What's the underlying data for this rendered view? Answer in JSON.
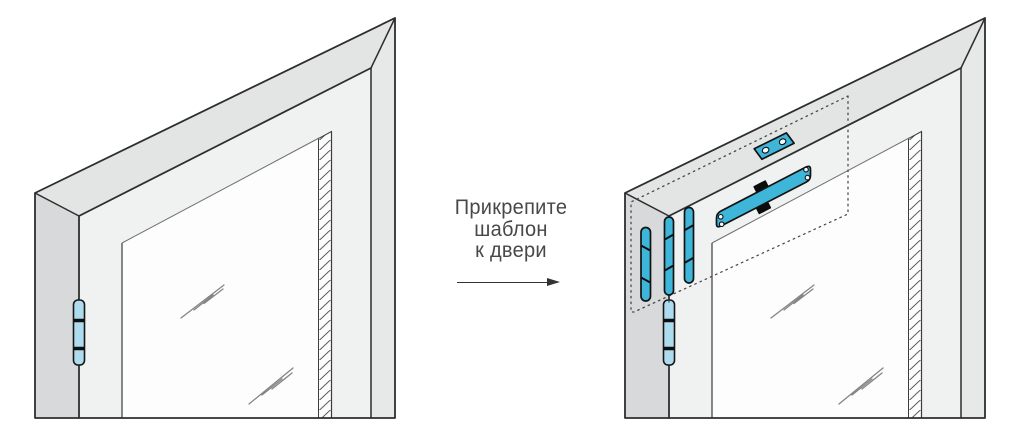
{
  "caption": {
    "line1": "Прикрепите",
    "line2": "шаблон",
    "line3": "к двери"
  },
  "arrow": {
    "direction": "right"
  },
  "colors": {
    "face_side": "#d8d9da",
    "face_top": "#e3e4e4",
    "face_front": "#f0f1f1",
    "face_right": "#e7e8e8",
    "glass": "#fdfdfd",
    "line": "#2e2e2e",
    "template_blue": "#3db6d9",
    "hinge_blue": "#addcee",
    "dotted": "#4a4a4a",
    "text": "#484848",
    "arrow": "#333333"
  }
}
